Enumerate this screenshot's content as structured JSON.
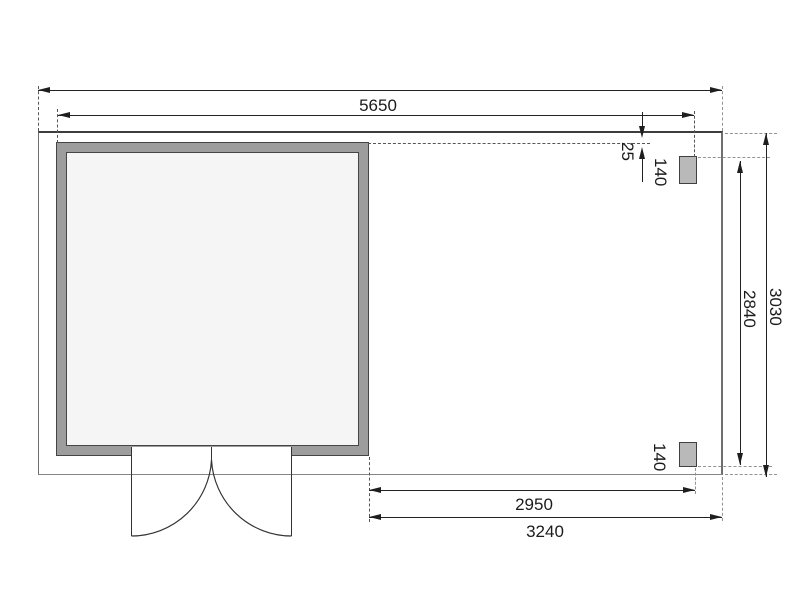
{
  "dimensions": {
    "top_width": "5650",
    "overhang": "25",
    "post_top": "140",
    "inner_depth": "2840",
    "outer_depth": "3030",
    "post_bottom": "140",
    "bottom_inner_width": "2950",
    "bottom_outer_width": "3240"
  },
  "colors": {
    "background": "#ffffff",
    "dimension_line": "#222222",
    "wall_fill": "#9d9d9d",
    "wall_border": "#454545",
    "interior_fill": "#f5f5f5",
    "post_fill": "#b9b9b9",
    "outline": "#6f6f6f"
  }
}
